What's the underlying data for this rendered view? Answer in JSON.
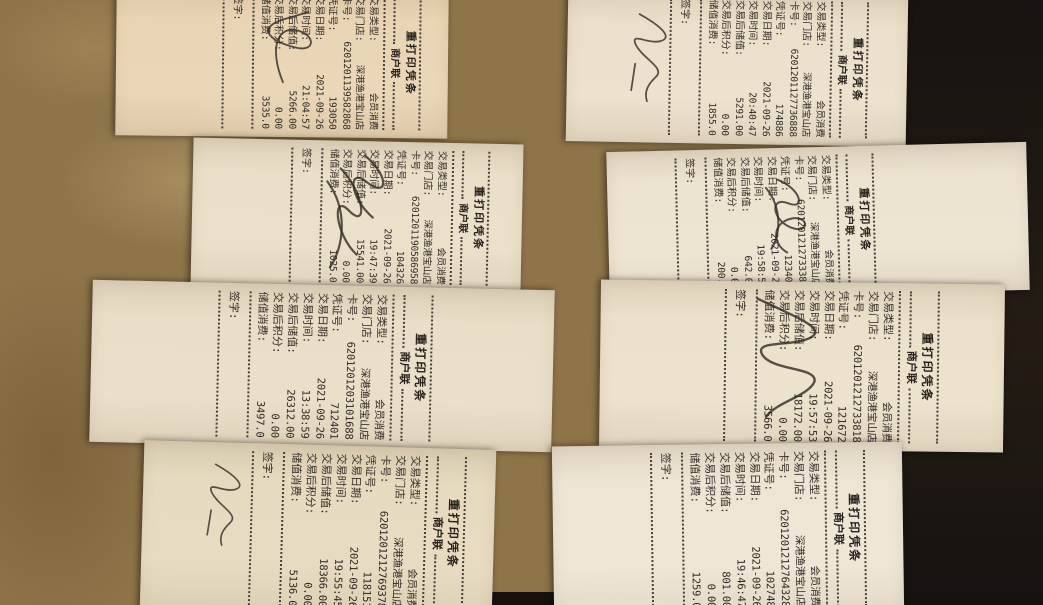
{
  "colors": {
    "table_marble": "#8d7449",
    "background_dark": "#1c1611",
    "receipt_paper": "#ece2cf",
    "ink": "#36302a"
  },
  "common": {
    "title": "重打印凭条",
    "copy_label": "商户联",
    "sign_label": "签字:",
    "labels": {
      "type": "交易类型:",
      "store": "交易门店:",
      "card": "卡号:",
      "voucher": "凭证号:",
      "date": "交易日期:",
      "time": "交易时间:",
      "balance_after": "交易后储值:",
      "points_after": "交易后积分:",
      "spend": "储值消费:"
    }
  },
  "receipts": [
    {
      "type": "会员消费",
      "store": "深港渔港宝山店",
      "card": "6201201139582868",
      "voucher": "193050",
      "date": "2021-09-26",
      "time": "21:04:57",
      "balance_after": "5266.00",
      "points_after": "0.00",
      "spend": "3535.0"
    },
    {
      "type": "会员消费",
      "store": "深港渔港宝山店",
      "card": "6201201127736888",
      "voucher": "174886",
      "date": "2021-09-26",
      "time": "20:40:47",
      "balance_after": "5291.00",
      "points_after": "0.00",
      "spend": "1855.0"
    },
    {
      "type": "会员消费",
      "store": "深港渔港宝山店",
      "card": "6201201190586958",
      "voucher": "104326",
      "date": "2021-09-26",
      "time": "19:47:39",
      "balance_after": "15541.00",
      "points_after": "0.00",
      "spend": "1025.0"
    },
    {
      "type": "会员消费",
      "store": "深港渔港宝山店",
      "card": "6201201212733388",
      "voucher": "123407",
      "date": "2021-09-26",
      "time": "19:58:55",
      "balance_after": "642.00",
      "points_after": "0.00",
      "spend": "200.0"
    },
    {
      "type": "会员消费",
      "store": "深港渔港宝山店",
      "card": "6201201203101688",
      "voucher": "712401",
      "date": "2021-09-26",
      "time": "13:38:59",
      "balance_after": "26312.00",
      "points_after": "0.00",
      "spend": "3497.0"
    },
    {
      "type": "会员消费",
      "store": "深港渔港宝山店",
      "card": "6201201212733818",
      "voucher": "121672",
      "date": "2021-09-26",
      "time": "19:57:53",
      "balance_after": "18172.00",
      "points_after": "0.00",
      "spend": "3566.0"
    },
    {
      "type": "会员消费",
      "store": "深港渔港宝山店",
      "card": "6201201212769378",
      "voucher": "118151",
      "date": "2021-09-26",
      "time": "19:55:45",
      "balance_after": "18366.00",
      "points_after": "0.00",
      "spend": "5136.0"
    },
    {
      "type": "会员消费",
      "store": "深港渔港宝山店",
      "card": "6201201212764328",
      "voucher": "102748",
      "date": "2021-09-26",
      "time": "19:46:47",
      "balance_after": "801.00",
      "points_after": "0.00",
      "spend": "1259.0"
    }
  ]
}
